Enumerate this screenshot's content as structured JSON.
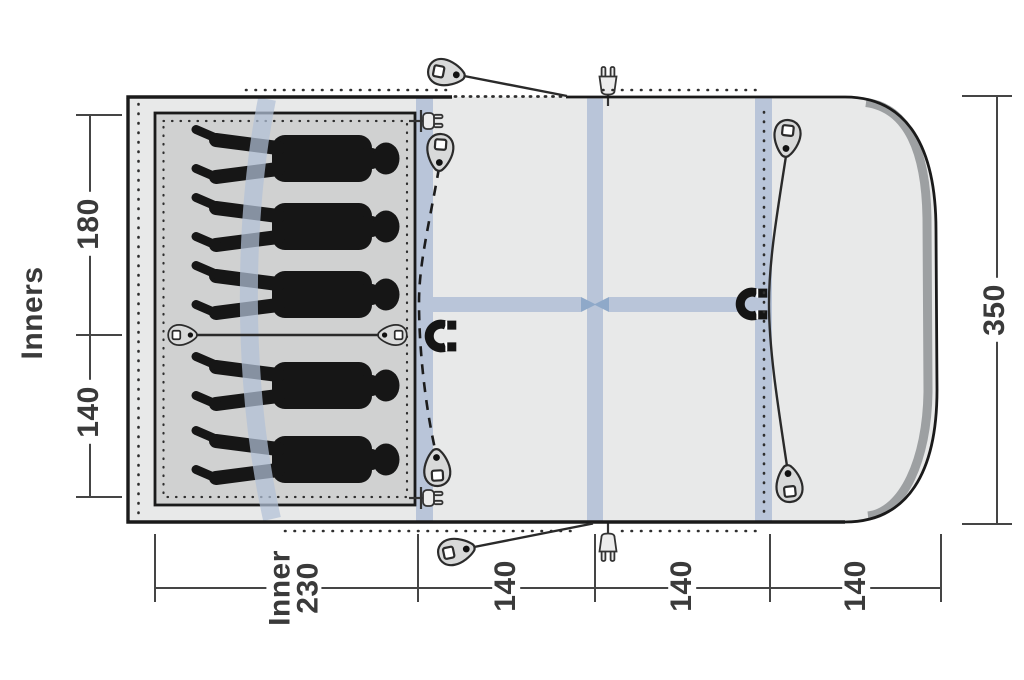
{
  "title": "Tent floor plan top view",
  "side_label": "Inners",
  "dims": {
    "left_top": "180",
    "left_bottom": "140",
    "right": "350",
    "bottom_1": "Inner\n230",
    "bottom_2": "140",
    "bottom_3": "140",
    "bottom_4": "140"
  },
  "sleeping_figures": 5,
  "icons": [
    "tension-toggle-icon",
    "magnet-closure-icon",
    "power-inlet-icon",
    "guy-line",
    "air-pole-band",
    "door-zip-dashed-line"
  ],
  "colors": {
    "canvas_gray": "#e8e9e9",
    "cabin_gray": "#d0d1d1",
    "pole_blue": "#b9c5d9",
    "pole_blue_dark": "#8fa9c9",
    "pole_blue_translucent": "rgba(177,192,215,0.72)",
    "sleeve_gray": "#9da0a2",
    "line": "#1a1a1a",
    "figure": "#161616",
    "dim_line": "#454545",
    "dim_text": "#3a3a3a"
  }
}
